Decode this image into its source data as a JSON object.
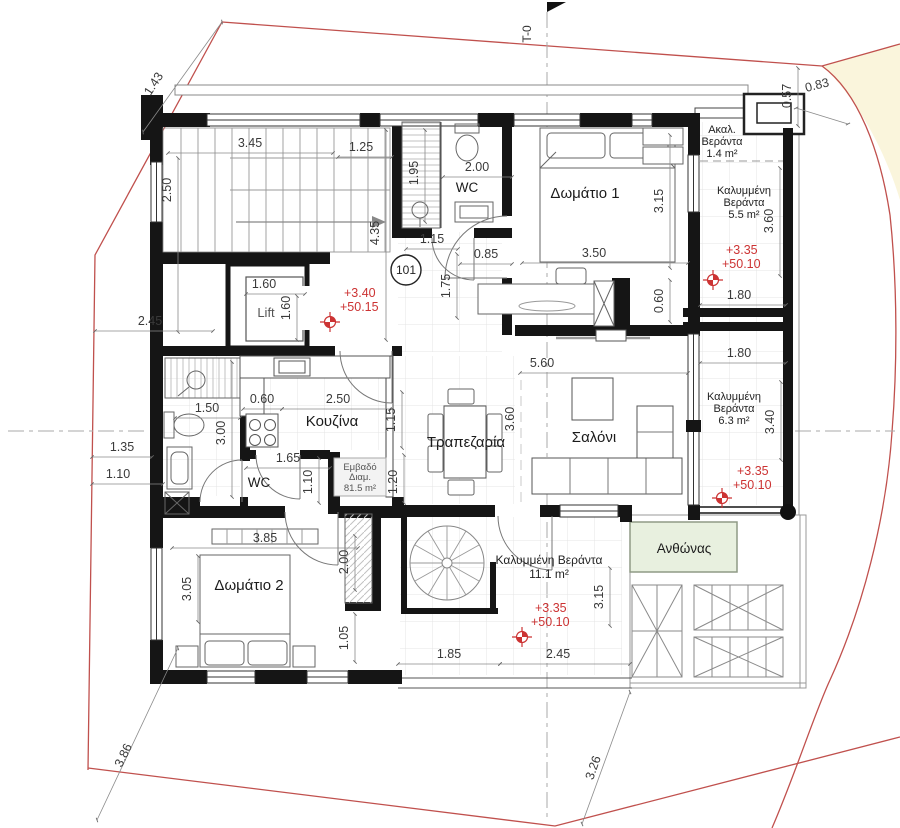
{
  "plan": {
    "section_marker": "T-0",
    "apartment_number": "101",
    "colors": {
      "boundary_line": "#c0504d",
      "level_text": "#cc3333",
      "site_fill": "#faf5dc",
      "planter_fill": "#e8f0df"
    },
    "rooms": {
      "bedroom1": "Δωμάτιο 1",
      "bedroom2": "Δωμάτιο 2",
      "kitchen": "Κουζίνα",
      "dining": "Τραπεζαρία",
      "living": "Σαλόνι",
      "wc_top": "WC",
      "wc_bottom": "WC",
      "lift": "Lift",
      "planter": "Ανθώνας"
    },
    "verandas": {
      "open": {
        "l1": "Ακαλ.",
        "l2": "Βεράντα",
        "l3": "1.4 m²"
      },
      "covered_a": {
        "l1": "Καλυμμένη",
        "l2": "Βεράντα",
        "l3": "5.5 m²"
      },
      "covered_b": {
        "l1": "Καλυμμένη",
        "l2": "Βεράντα",
        "l3": "6.3 m²"
      },
      "covered_c": {
        "l1": "Καλυμμένη Βεράντα",
        "l2": "11.1 m²"
      }
    },
    "area_box": {
      "l1": "Εμβαδό",
      "l2": "Διαμ.",
      "l3": "81.5 m²"
    },
    "levels": {
      "entry": {
        "a": "+3.40",
        "b": "+50.15"
      },
      "ver_a": {
        "a": "+3.35",
        "b": "+50.10"
      },
      "ver_b": {
        "a": "+3.35",
        "b": "+50.10"
      },
      "ver_c": {
        "a": "+3.35",
        "b": "+50.10"
      }
    },
    "dims": {
      "stair_w": "3.45",
      "stair_d": "2.50",
      "top_off": "1.25",
      "shower": "1.95",
      "hall_len": "4.35",
      "wc1": "2.00",
      "entry_a": "1.15",
      "entry_b": "0.85",
      "entry_c": "1.75",
      "bed1_w": "3.50",
      "bed1_d": "3.15",
      "bed1_s": "0.60",
      "lift_w": "1.60",
      "lift_d": "1.60",
      "left_a": "2.45",
      "left_b": "1.35",
      "left_c": "1.10",
      "bath_w": "1.50",
      "bath_d": "3.00",
      "kit_a": "0.60",
      "kit_w": "2.50",
      "kit_c": "1.15",
      "wc2_w": "1.65",
      "wc2_d": "1.10",
      "hall_w": "1.20",
      "liv_w": "5.60",
      "liv_d": "3.60",
      "bed2_w": "3.85",
      "bed2_d": "3.05",
      "closet_d": "2.00",
      "bed2_s": "1.05",
      "ver3_d": "3.15",
      "ver3_a": "1.85",
      "ver3_b": "2.45",
      "ver1_d": "3.60",
      "ver1_w": "1.80",
      "ver2_w": "1.80",
      "ver2_d": "3.40",
      "site_a": "1.43",
      "site_b": "0.57",
      "site_c": "0.83",
      "site_d": "3.86",
      "site_e": "3.26"
    }
  }
}
